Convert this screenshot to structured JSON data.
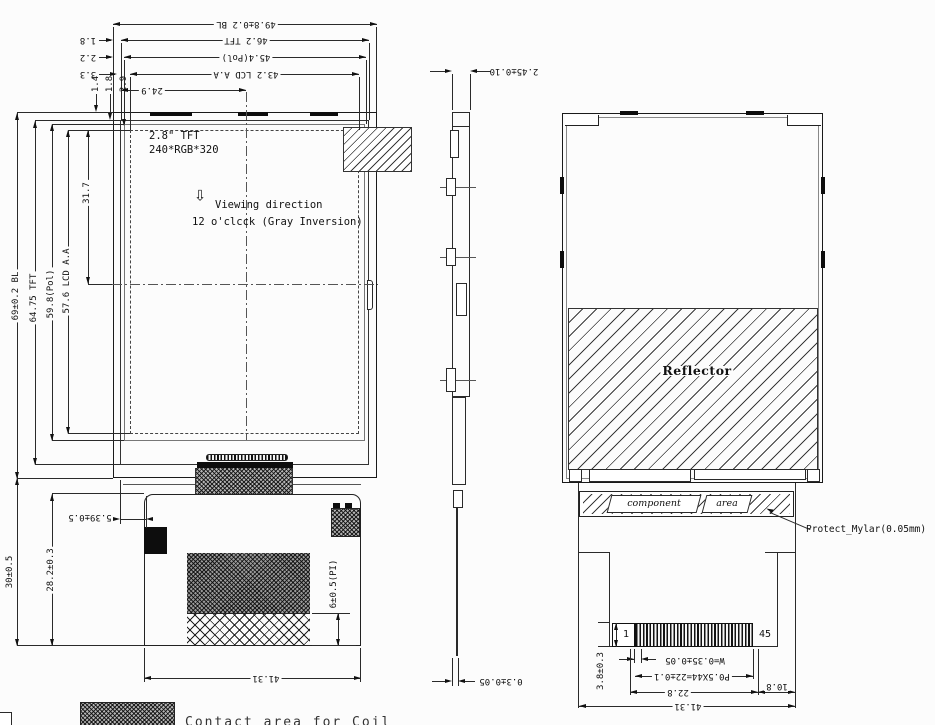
{
  "drawing": {
    "front": {
      "labels": {
        "size": "2.8\" TFT",
        "resolution": "240*RGB*320",
        "viewing_line1": "Viewing direction",
        "viewing_line2": "12 o'clcck (Gray Inversion)"
      },
      "top_dims": {
        "bl": "49.8±0.2 BL",
        "tft": "46.2 TFT",
        "pol": "45.4(Pol)",
        "aa": "43.2 LCD A.A",
        "center": "24.9",
        "offset_tft": "1.8",
        "offset_pol": "2.2",
        "offset_aa": "3.3",
        "gap_1": "1.4",
        "gap_2": "1.8",
        "gap_3": "2.9"
      },
      "left_dims": {
        "bl": "69±0.2 BL",
        "tft": "64.75 TFT",
        "pol": "59.8(Pol)",
        "aa": "57.6 LCD A.A",
        "aa_center": "31.7",
        "fpc_total": "30±0.5",
        "fpc_body": "28.2±0.3",
        "fpc_offset": "5.39±0.5"
      },
      "bottom_dims": {
        "pi_thickness": "6±0.5(PI)",
        "fpc_width": "41.31"
      }
    },
    "side": {
      "dims": {
        "thickness": "2.45±0.10",
        "fpc_thickness": "0.3±0.05"
      }
    },
    "back": {
      "labels": {
        "reflector": "Reflector",
        "component": "component",
        "area": "area",
        "mylar": "Protect_Mylar(0.05mm)",
        "pin_first": "1",
        "pin_last": "45"
      },
      "dims": {
        "pin_zone": "3.8±0.3",
        "pin_width": "W=0.35±0.05",
        "pitch": "P0.5X44=22±0.1",
        "contact_span": "22.8",
        "edge_margin": "10.8",
        "fpc_width": "41.31"
      }
    },
    "legend": {
      "caption_partial": "Contact area for Coil"
    },
    "icons": {
      "viewing_direction_arrow": "⇩"
    }
  }
}
